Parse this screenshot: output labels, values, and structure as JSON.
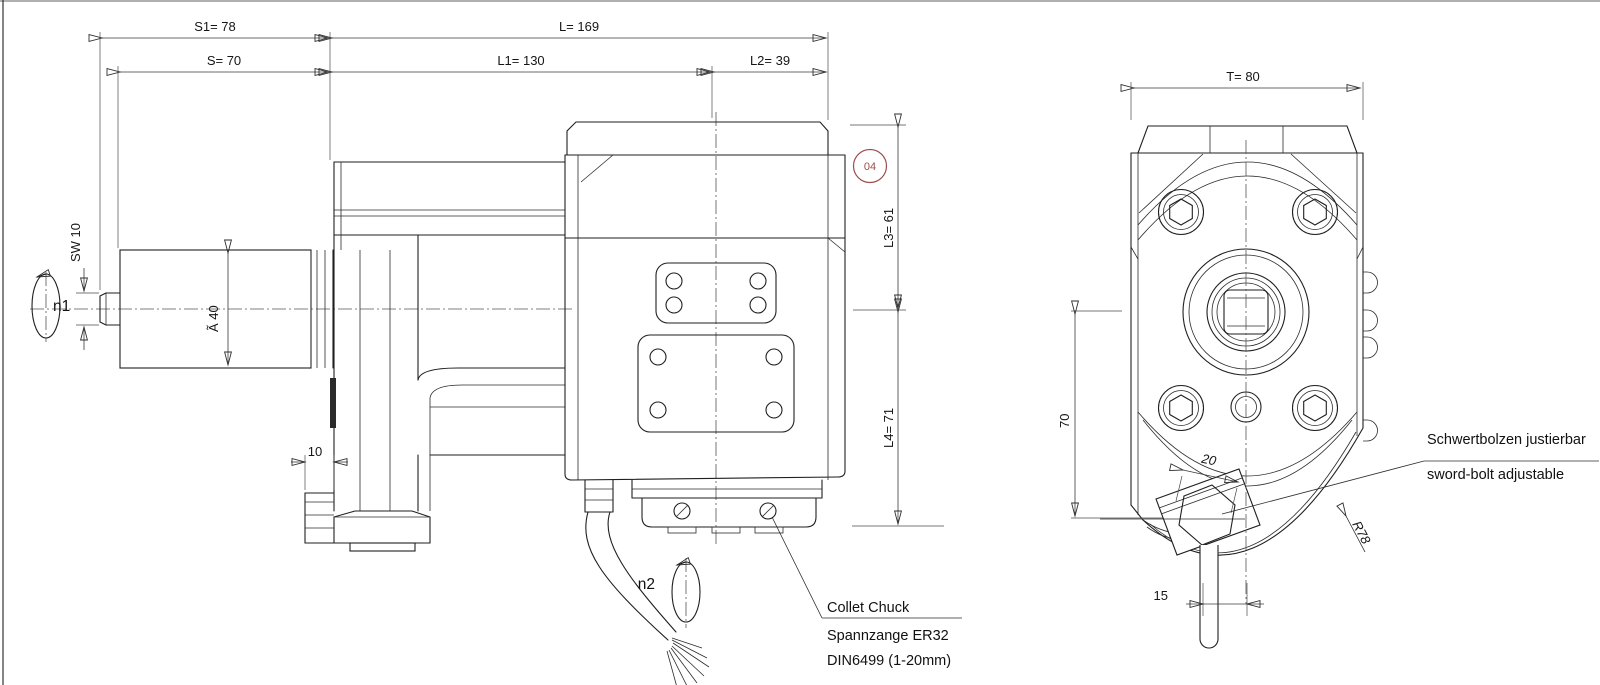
{
  "colors": {
    "line": "#1f1f1f",
    "dimension": "#3a3a3a",
    "balloon_red": "#9c4f4f",
    "background": "#ffffff"
  },
  "side_view": {
    "dims": {
      "s1": "S1= 78",
      "s": "S= 70",
      "l": "L= 169",
      "l1": "L1= 130",
      "l2": "L2= 39",
      "l3": "L3= 61",
      "l4": "L4= 71",
      "sw": "SW 10",
      "dia": "Ã 40",
      "offset10": "10"
    },
    "labels": {
      "n1": "n1",
      "n2": "n2",
      "balloon": "04",
      "collet_1": "Collet Chuck",
      "collet_2": "Spannzange ER32",
      "collet_3": "DIN6499 (1-20mm)"
    }
  },
  "front_view": {
    "dims": {
      "t": "T= 80",
      "h70": "70",
      "w20": "20",
      "w15": "15",
      "r78": "R78"
    },
    "labels": {
      "sword_de": "Schwertbolzen justierbar",
      "sword_en": "sword-bolt adjustable"
    }
  }
}
